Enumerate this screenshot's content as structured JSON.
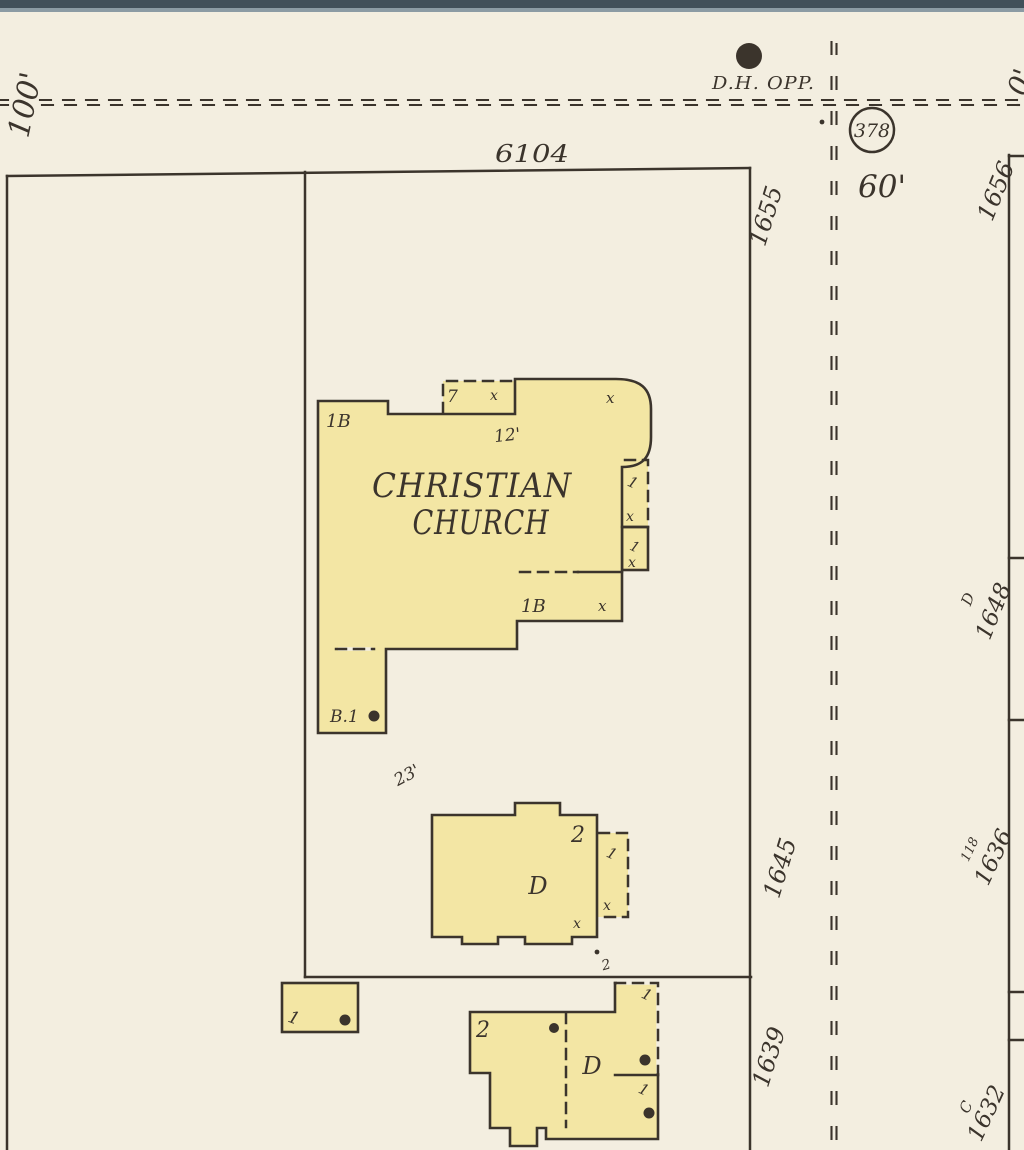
{
  "colors": {
    "paper": "#f3eee0",
    "building_fill": "#f3e6a4",
    "ink": "#3b342c",
    "sheet_edge_dark": "#41505a",
    "sheet_edge_light": "#8b9ba4"
  },
  "street": {
    "width_label_west": "100'",
    "utility_note": "D.H. OPP.",
    "block_circle_number": "378",
    "width_label_east": "60'",
    "width_label_edge": "0'"
  },
  "lot": {
    "number": "6104"
  },
  "church": {
    "name_line1": "CHRISTIAN",
    "name_line2": "CHURCH",
    "stories_main": "1B",
    "porch_front_width": "7",
    "porch_front_flag": "x",
    "front_dim": "12'",
    "corner_flag": "x",
    "side_porch_story_a": "1",
    "side_porch_flag_a": "x",
    "side_porch_story_b": "1",
    "side_porch_flag_b": "x",
    "wing_stories": "1B",
    "wing_flag": "x",
    "basement_note": "B.1",
    "yard_dim": "23'"
  },
  "house_mid": {
    "stories": "2",
    "code": "D",
    "flag": "x",
    "porch_story": "1",
    "porch_flag": "x",
    "rear_note": "2"
  },
  "shed": {
    "stories": "1"
  },
  "house_bottom": {
    "stories": "2",
    "code": "D",
    "porch_story_a": "1",
    "porch_story_b": "1"
  },
  "addresses_west": [
    "1655",
    "1645",
    "1639"
  ],
  "addresses_east": [
    {
      "code": "",
      "number": "1656"
    },
    {
      "code": "D",
      "number": "1648"
    },
    {
      "code": "118",
      "number": "1636"
    },
    {
      "code": "C",
      "number": "1632"
    }
  ]
}
